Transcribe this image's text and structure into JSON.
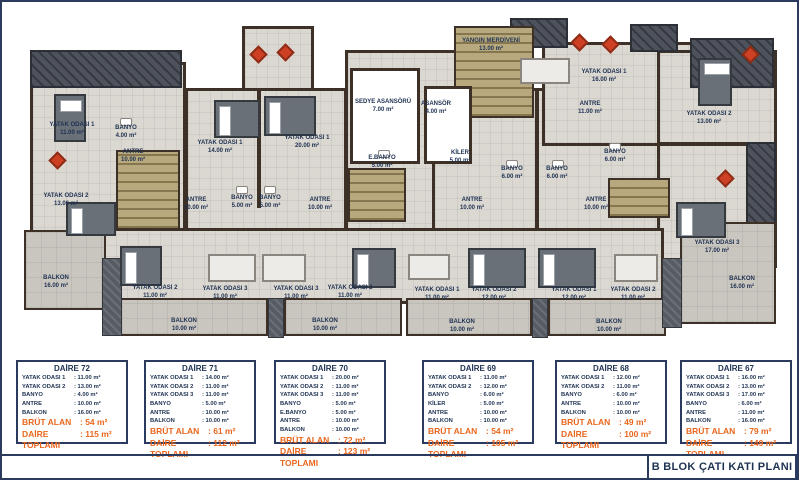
{
  "title_block": {
    "text": "B BLOK ÇATI KATI PLANI"
  },
  "colors": {
    "navy": "#1e3252",
    "orange": "#e9671d",
    "wall_brown": "#3d3026",
    "floor": "#dbd7d1",
    "balcony": "#c9c5bf",
    "roof_slate": "#4d525c",
    "stairs_khaki": "#b7a97d",
    "accent_red": "#ce4023"
  },
  "plan": {
    "labels": [
      {
        "label": "YATAK ODASI 1",
        "area": "11.00 m²",
        "x": 70,
        "y": 128
      },
      {
        "label": "BANYO",
        "area": "4.00 m²",
        "x": 124,
        "y": 131
      },
      {
        "label": "ANTRE",
        "area": "10.00 m²",
        "x": 131,
        "y": 155
      },
      {
        "label": "YATAK ODASI 2",
        "area": "13.00 m²",
        "x": 64,
        "y": 199
      },
      {
        "label": "BALKON",
        "area": "16.00 m²",
        "x": 54,
        "y": 281
      },
      {
        "label": "YATAK ODASI 1",
        "area": "14.00 m²",
        "x": 218,
        "y": 146
      },
      {
        "label": "ANTRE",
        "area": "10.00 m²",
        "x": 194,
        "y": 203
      },
      {
        "label": "BANYO",
        "area": "5.00 m²",
        "x": 240,
        "y": 201
      },
      {
        "label": "BANYO",
        "area": "5.00 m²",
        "x": 268,
        "y": 201
      },
      {
        "label": "YATAK ODASI 2",
        "area": "11.00 m²",
        "x": 153,
        "y": 291
      },
      {
        "label": "YATAK ODASI 3",
        "area": "11.00 m²",
        "x": 223,
        "y": 292
      },
      {
        "label": "BALKON",
        "area": "10.00 m²",
        "x": 182,
        "y": 324
      },
      {
        "label": "YATAK ODASI 1",
        "area": "20.00 m²",
        "x": 305,
        "y": 141
      },
      {
        "label": "ANTRE",
        "area": "10.00 m²",
        "x": 318,
        "y": 203
      },
      {
        "label": "E.BANYO",
        "area": "5.00 m²",
        "x": 380,
        "y": 161
      },
      {
        "label": "YATAK ODASI 2",
        "area": "11.00 m²",
        "x": 348,
        "y": 291
      },
      {
        "label": "YATAK ODASI 3",
        "area": "11.00 m²",
        "x": 294,
        "y": 292
      },
      {
        "label": "BALKON",
        "area": "10.00 m²",
        "x": 323,
        "y": 324
      },
      {
        "label": "SEDYE ASANSÖRÜ",
        "area": "7.00 m²",
        "x": 381,
        "y": 105
      },
      {
        "label": "ASANSÖR",
        "area": "4.00 m²",
        "x": 434,
        "y": 107
      },
      {
        "label": "YANGIN MERDİVENİ",
        "area": "13.00 m²",
        "x": 489,
        "y": 44
      },
      {
        "label": "KİLER",
        "area": "5.00 m²",
        "x": 458,
        "y": 156
      },
      {
        "label": "ANTRE",
        "area": "10.00 m²",
        "x": 470,
        "y": 203
      },
      {
        "label": "BANYO",
        "area": "6.00 m²",
        "x": 510,
        "y": 172
      },
      {
        "label": "BANYO",
        "area": "6.00 m²",
        "x": 555,
        "y": 172
      },
      {
        "label": "YATAK ODASI 1",
        "area": "11.00 m²",
        "x": 435,
        "y": 293
      },
      {
        "label": "YATAK ODASI 2",
        "area": "12.00 m²",
        "x": 492,
        "y": 293
      },
      {
        "label": "BALKON",
        "area": "10.00 m²",
        "x": 460,
        "y": 325
      },
      {
        "label": "ANTRE",
        "area": "10.00 m²",
        "x": 594,
        "y": 203
      },
      {
        "label": "YATAK ODASI 1",
        "area": "12.00 m²",
        "x": 572,
        "y": 293
      },
      {
        "label": "YATAK ODASI 2",
        "area": "11.00 m²",
        "x": 631,
        "y": 293
      },
      {
        "label": "BALKON",
        "area": "10.00 m²",
        "x": 607,
        "y": 325
      },
      {
        "label": "ANTRE",
        "area": "11.00 m²",
        "x": 588,
        "y": 107
      },
      {
        "label": "YATAK ODASI 1",
        "area": "16.00 m²",
        "x": 602,
        "y": 75
      },
      {
        "label": "BANYO",
        "area": "6.00 m²",
        "x": 613,
        "y": 155
      },
      {
        "label": "YATAK ODASI 2",
        "area": "13.00 m²",
        "x": 707,
        "y": 117
      },
      {
        "label": "YATAK ODASI 3",
        "area": "17.00 m²",
        "x": 715,
        "y": 246
      },
      {
        "label": "BALKON",
        "area": "16.00 m²",
        "x": 740,
        "y": 282
      }
    ]
  },
  "units": [
    {
      "name": "DAİRE 72",
      "x": 14,
      "rows": [
        {
          "label": "YATAK ODASI 1",
          "value": ": 11.00 m²"
        },
        {
          "label": "YATAK ODASI 2",
          "value": ": 13.00 m²"
        },
        {
          "label": "BANYO",
          "value": ": 4.00 m²"
        },
        {
          "label": "ANTRE",
          "value": ": 10.00 m²"
        },
        {
          "label": "BALKON",
          "value": ": 16.00 m²"
        }
      ],
      "brut_label": "BRÜT ALAN",
      "brut_value": ": 54 m²",
      "total_label": "DAİRE TOPLAMI",
      "total_value": ": 115 m²"
    },
    {
      "name": "DAİRE 71",
      "x": 142,
      "rows": [
        {
          "label": "YATAK ODASI 1",
          "value": ": 14.00 m²"
        },
        {
          "label": "YATAK ODASI 2",
          "value": ": 11.00 m²"
        },
        {
          "label": "YATAK ODASI 3",
          "value": ": 11.00 m²"
        },
        {
          "label": "BANYO",
          "value": ": 5.00 m²"
        },
        {
          "label": "ANTRE",
          "value": ": 10.00 m²"
        },
        {
          "label": "BALKON",
          "value": ": 10.00 m²"
        }
      ],
      "brut_label": "BRÜT ALAN",
      "brut_value": ": 61 m²",
      "total_label": "DAİRE TOPLAMI",
      "total_value": ": 112 m²"
    },
    {
      "name": "DAİRE 70",
      "x": 272,
      "rows": [
        {
          "label": "YATAK ODASI 1",
          "value": ": 20.00 m²"
        },
        {
          "label": "YATAK ODASI 2",
          "value": ": 11.00 m²"
        },
        {
          "label": "YATAK ODASI 3",
          "value": ": 11.00 m²"
        },
        {
          "label": "BANYO",
          "value": ": 5.00 m²"
        },
        {
          "label": "E.BANYO",
          "value": ": 5.00 m²"
        },
        {
          "label": "ANTRE",
          "value": ": 10.00 m²"
        },
        {
          "label": "BALKON",
          "value": ": 10.00 m²"
        }
      ],
      "brut_label": "BRÜT ALAN",
      "brut_value": ": 72 m²",
      "total_label": "DAİRE TOPLAMI",
      "total_value": ": 123 m²"
    },
    {
      "name": "DAİRE 69",
      "x": 420,
      "rows": [
        {
          "label": "YATAK ODASI 1",
          "value": ": 11.00 m²"
        },
        {
          "label": "YATAK ODASI 2",
          "value": ": 12.00 m²"
        },
        {
          "label": "BANYO",
          "value": ": 6.00 m²"
        },
        {
          "label": "KİLER",
          "value": ": 5.00 m²"
        },
        {
          "label": "ANTRE",
          "value": ": 10.00 m²"
        },
        {
          "label": "BALKON",
          "value": ": 10.00 m²"
        }
      ],
      "brut_label": "BRÜT ALAN",
      "brut_value": ": 54 m²",
      "total_label": "DAİRE TOPLAMI",
      "total_value": ": 105 m²"
    },
    {
      "name": "DAİRE 68",
      "x": 553,
      "rows": [
        {
          "label": "YATAK ODASI 1",
          "value": ": 12.00 m²"
        },
        {
          "label": "YATAK ODASI 2",
          "value": ": 11.00 m²"
        },
        {
          "label": "BANYO",
          "value": ": 6.00 m²"
        },
        {
          "label": "ANTRE",
          "value": ": 10.00 m²"
        },
        {
          "label": "BALKON",
          "value": ": 10.00 m²"
        }
      ],
      "brut_label": "BRÜT ALAN",
      "brut_value": ": 49 m²",
      "total_label": "DAİRE TOPLAMI",
      "total_value": ": 100 m²"
    },
    {
      "name": "DAİRE 67",
      "x": 678,
      "rows": [
        {
          "label": "YATAK ODASI 1",
          "value": ": 16.00 m²"
        },
        {
          "label": "YATAK ODASI 2",
          "value": ": 13.00 m²"
        },
        {
          "label": "YATAK ODASI 3",
          "value": ": 17.00 m²"
        },
        {
          "label": "BANYO",
          "value": ": 6.00 m²"
        },
        {
          "label": "ANTRE",
          "value": ": 11.00 m²"
        },
        {
          "label": "BALKON",
          "value": ": 16.00 m²"
        }
      ],
      "brut_label": "BRÜT ALAN",
      "brut_value": ": 79 m²",
      "total_label": "DAİRE TOPLAMI",
      "total_value": ": 149 m²"
    }
  ]
}
